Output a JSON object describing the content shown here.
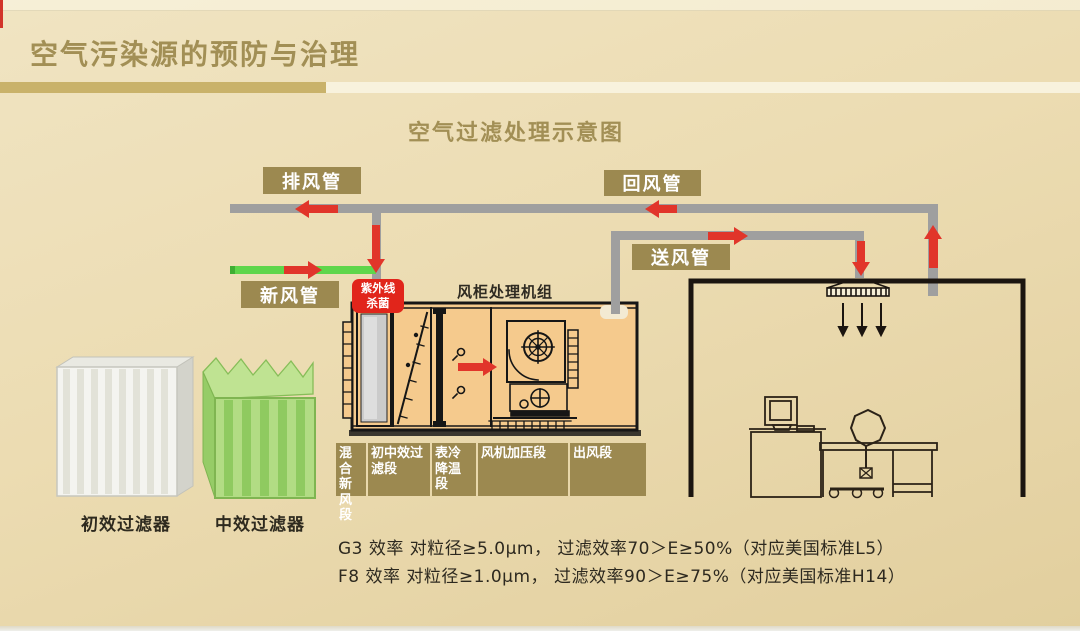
{
  "header": {
    "title": "空气污染源的预防与治理"
  },
  "diagram": {
    "title": "空气过滤处理示意图",
    "duct_labels": {
      "exhaust": "排风管",
      "return": "回风管",
      "supply": "送风管",
      "fresh": "新风管"
    },
    "uv": {
      "line1": "紫外线",
      "line2": "杀菌"
    },
    "ahu": {
      "title": "风柜处理机组",
      "sections": [
        {
          "label": "混合新风段"
        },
        {
          "label": "初中效过滤段"
        },
        {
          "label": "表冷降温段"
        },
        {
          "label": "风机加压段"
        },
        {
          "label": "出风段"
        }
      ]
    },
    "filters": [
      {
        "label": "初效过滤器"
      },
      {
        "label": "中效过滤器"
      }
    ],
    "notes": [
      "G3 效率 对粒径≥5.0μm， 过滤效率70＞E≥50%（对应美国标准L5）",
      "F8 效率 对粒径≥1.0μm， 过滤效率90＞E≥75%（对应美国标准H14）"
    ],
    "colors": {
      "background_tan": "#ecdcb2",
      "label_gold": "#9c8950",
      "accent_red": "#e1352a",
      "duct_gray": "#9f9f9f",
      "fresh_green": "#5fd64b",
      "ahu_fill": "#f5ca8d",
      "title_gold": "#a28f55"
    }
  }
}
